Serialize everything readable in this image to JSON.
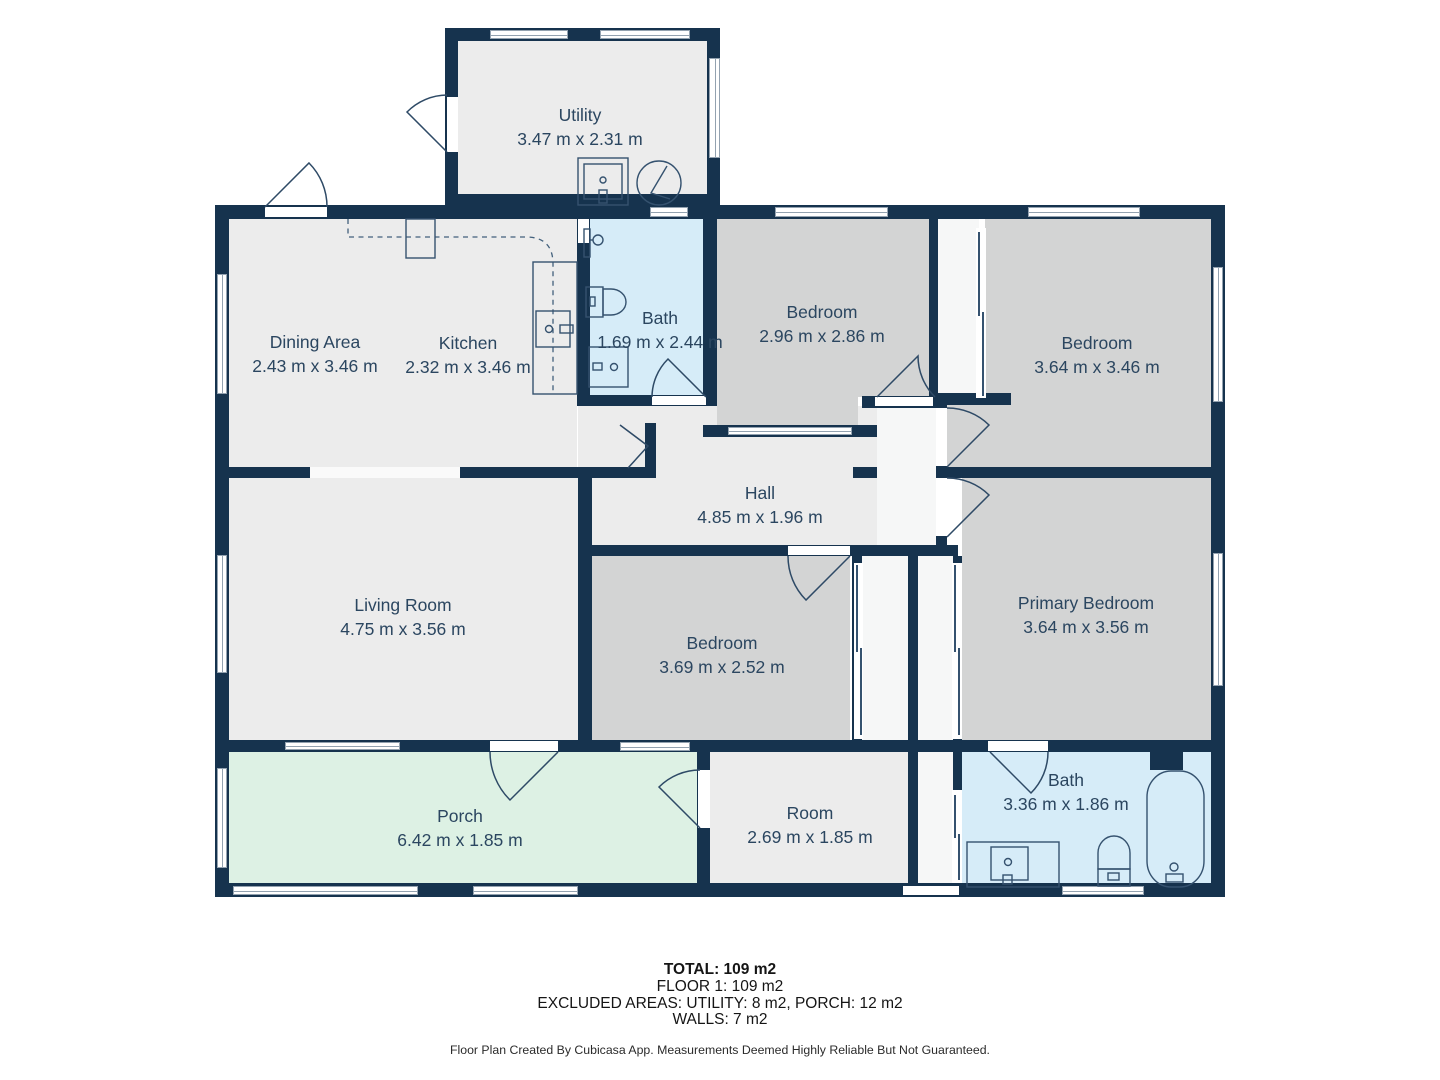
{
  "colors": {
    "wall": "#16334e",
    "room_default": "#ececec",
    "room_bedroom": "#d3d4d4",
    "room_bath": "#d6ecf8",
    "room_porch": "#ddf1e4",
    "room_closet": "#f6f7f7",
    "label_text": "#2b4660",
    "summary_text": "#151515"
  },
  "rooms": {
    "utility": {
      "name": "Utility",
      "dims": "3.47 m x 2.31 m"
    },
    "dining": {
      "name": "Dining Area",
      "dims": "2.43 m x 3.46 m"
    },
    "kitchen": {
      "name": "Kitchen",
      "dims": "2.32 m x 3.46 m"
    },
    "bath1": {
      "name": "Bath",
      "dims": "1.69 m x 2.44 m"
    },
    "bedroom1": {
      "name": "Bedroom",
      "dims": "2.96 m x 2.86 m"
    },
    "bedroom2": {
      "name": "Bedroom",
      "dims": "3.64 m x 3.46 m"
    },
    "hall": {
      "name": "Hall",
      "dims": "4.85 m x 1.96 m"
    },
    "living": {
      "name": "Living Room",
      "dims": "4.75 m x 3.56 m"
    },
    "bedroom3": {
      "name": "Bedroom",
      "dims": "3.69 m x 2.52 m"
    },
    "primary": {
      "name": "Primary Bedroom",
      "dims": "3.64 m x 3.56 m"
    },
    "porch": {
      "name": "Porch",
      "dims": "6.42 m x 1.85 m"
    },
    "room": {
      "name": "Room",
      "dims": "2.69 m x 1.85 m"
    },
    "bath2": {
      "name": "Bath",
      "dims": "3.36 m x 1.86 m"
    }
  },
  "summary": {
    "total": "TOTAL: 109 m2",
    "floor": "FLOOR 1: 109 m2",
    "excluded": "EXCLUDED AREAS: UTILITY: 8 m2, PORCH: 12 m2",
    "walls": "WALLS: 7 m2",
    "disclaimer": "Floor Plan Created By Cubicasa App. Measurements Deemed Highly Reliable But Not Guaranteed."
  }
}
